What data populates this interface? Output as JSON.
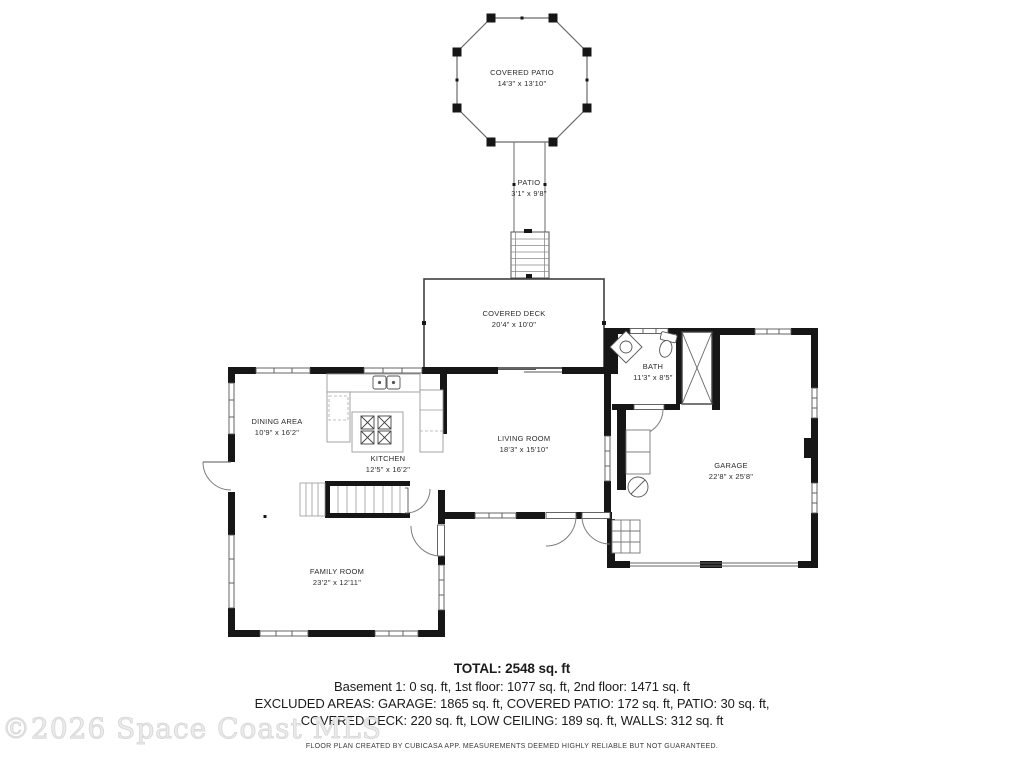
{
  "rooms": {
    "covered_patio": {
      "name": "COVERED PATIO",
      "dims": "14'3\" x 13'10\""
    },
    "patio": {
      "name": "PATIO",
      "dims": "3'1\" x 9'8\""
    },
    "covered_deck": {
      "name": "COVERED DECK",
      "dims": "20'4\" x 10'0\""
    },
    "bath": {
      "name": "BATH",
      "dims": "11'3\" x 8'5\""
    },
    "dining_area": {
      "name": "DINING AREA",
      "dims": "10'9\" x 16'2\""
    },
    "kitchen": {
      "name": "KITCHEN",
      "dims": "12'5\" x 16'2\""
    },
    "living_room": {
      "name": "LIVING ROOM",
      "dims": "18'3\" x 15'10\""
    },
    "garage": {
      "name": "GARAGE",
      "dims": "22'8\" x 25'8\""
    },
    "family_room": {
      "name": "FAMILY ROOM",
      "dims": "23'2\" x 12'11\""
    }
  },
  "summary": {
    "total": "TOTAL: 2548 sq. ft",
    "floors": "Basement 1: 0 sq. ft, 1st floor: 1077 sq. ft, 2nd floor: 1471 sq. ft",
    "excluded_line1": "EXCLUDED AREAS: GARAGE: 1865 sq. ft, COVERED PATIO: 172 sq. ft, PATIO: 30 sq. ft,",
    "excluded_line2": "COVERED DECK: 220 sq. ft, LOW CEILING: 189 sq. ft, WALLS: 312 sq. ft"
  },
  "disclaimer": "FLOOR PLAN CREATED BY CUBICASA APP. MEASUREMENTS DEEMED HIGHLY RELIABLE BUT NOT GUARANTEED.",
  "watermark": "©2026 Space Coast MLS",
  "colors": {
    "wall": "#161616",
    "thin_line": "#555555",
    "text": "#2b2b2b",
    "watermark": "#ececec",
    "background": "#ffffff"
  }
}
